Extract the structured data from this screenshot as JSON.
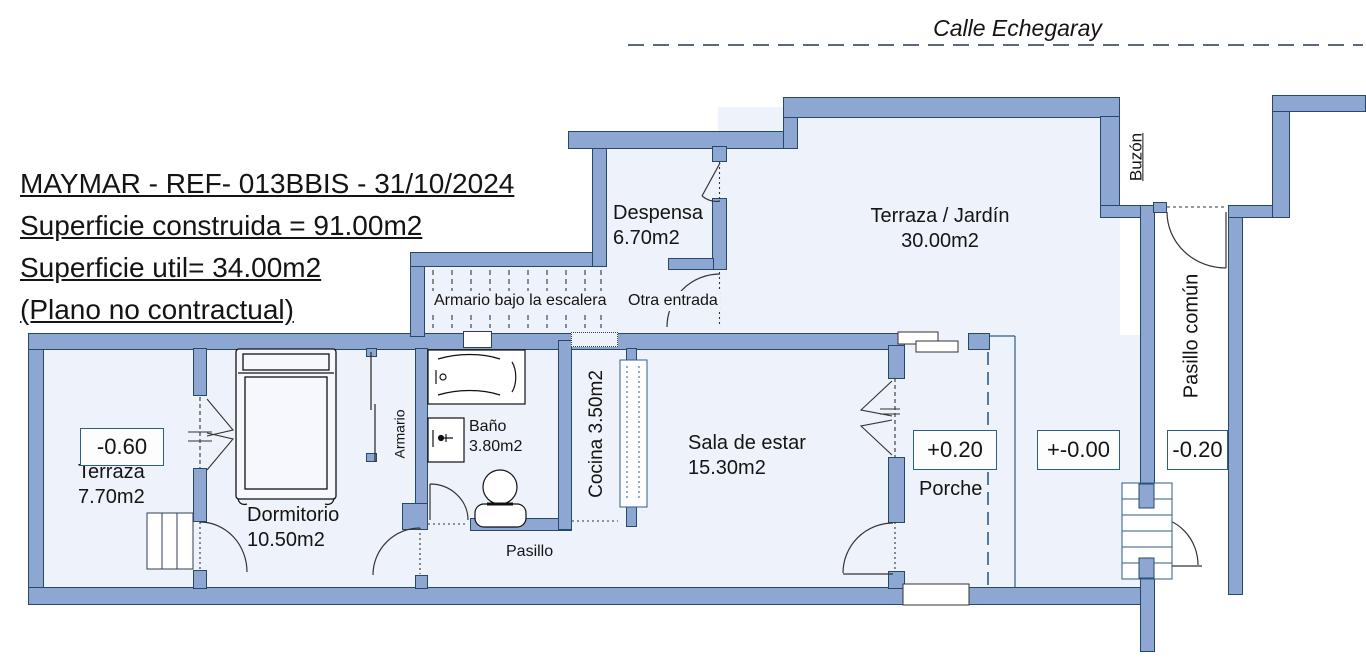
{
  "street": {
    "label": "Calle Echegaray"
  },
  "title_block": {
    "reference": "MAYMAR - REF- 013BBIS - 31/10/2024",
    "built_area": "Superficie construida = 91.00m2",
    "usable_area": "Superficie util= 34.00m2",
    "disclaimer": "(Plano no contractual)"
  },
  "rooms": {
    "despensa": {
      "name": "Despensa",
      "area": "6.70m2"
    },
    "terraza_jardin": {
      "name": "Terraza / Jardín",
      "area": "30.00m2"
    },
    "terraza": {
      "name": "Terraza",
      "area": "7.70m2"
    },
    "dormitorio": {
      "name": "Dormitorio",
      "area": "10.50m2"
    },
    "bano": {
      "name": "Baño",
      "area": "3.80m2"
    },
    "cocina": {
      "name": "Cocina 3.50m2"
    },
    "sala_de_estar": {
      "name": "Sala de estar",
      "area": "15.30m2"
    },
    "pasillo": {
      "name": "Pasillo"
    },
    "porche": {
      "name": "Porche"
    },
    "armario": {
      "name": "Armario"
    },
    "armario_bajo_escalera": {
      "name": "Armario bajo la escalera"
    },
    "otra_entrada": {
      "name": "Otra entrada"
    },
    "pasillo_comun": {
      "name": "Pasillo común"
    },
    "buzon": {
      "name": "Buzón"
    }
  },
  "levels": {
    "terraza": "-0.60",
    "porche": "+0.20",
    "exterior": "+-0.00",
    "pasillo_comun": "-0.20"
  },
  "colors": {
    "wall_fill": "#8da6d2",
    "wall_outline": "#274968",
    "floor": "#eef2fa"
  }
}
